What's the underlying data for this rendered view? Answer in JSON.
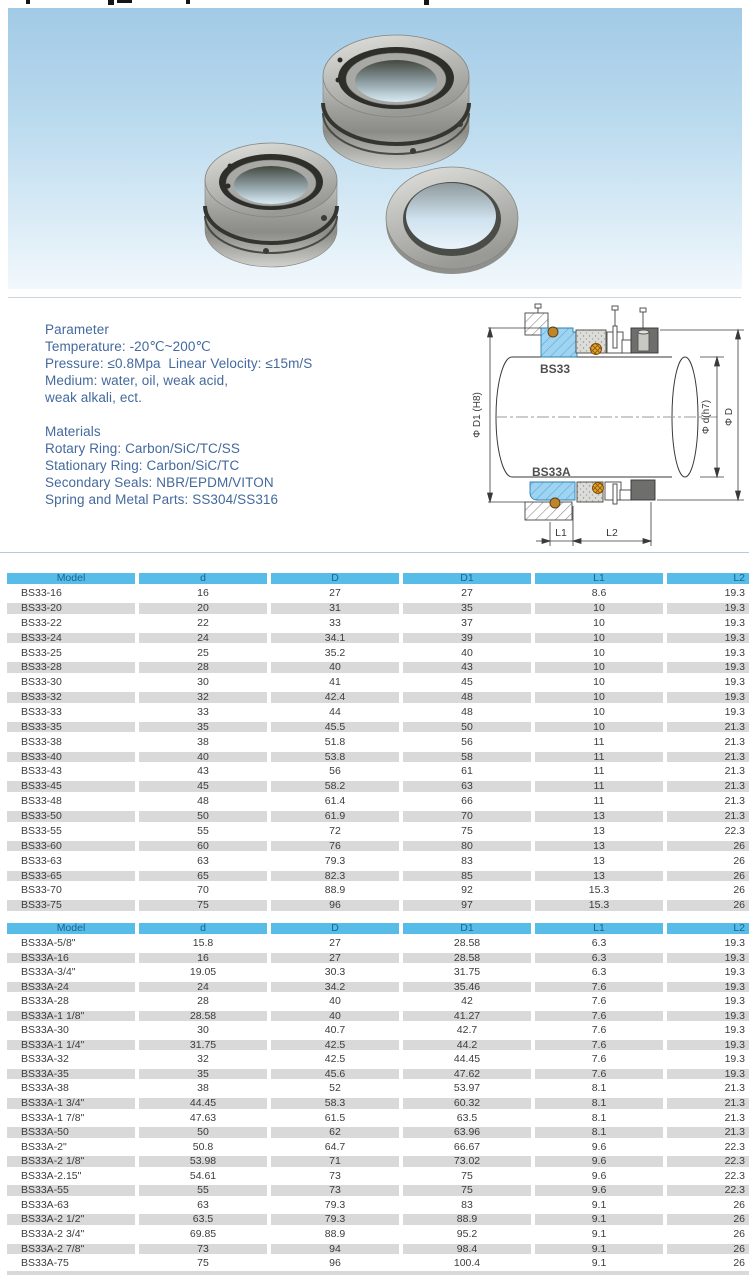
{
  "colors": {
    "table_header_bg": "#57bce8",
    "table_header_text": "#1a648f",
    "row_stripe": "#d9d9d9",
    "body_text": "#3c3c3c",
    "spec_text": "#44699d",
    "photo_bg_top": "#a2cae6",
    "diagram_blue": "#9ed4f2",
    "diagram_orange": "#e8a224"
  },
  "parameter_section": {
    "title": "Parameter",
    "lines": [
      "Temperature: -20℃~200℃",
      "Pressure: ≤0.8Mpa  Linear Velocity: ≤15m/S",
      "Medium: water, oil, weak acid,",
      "weak alkali, ect."
    ]
  },
  "materials_section": {
    "title": "Materials",
    "lines": [
      "Rotary Ring: Carbon/SiC/TC/SS",
      "Stationary Ring: Carbon/SiC/TC",
      "Secondary Seals: NBR/EPDM/VITON",
      "Spring and Metal Parts: SS304/SS316"
    ]
  },
  "diagram": {
    "top_model": "BS33",
    "bottom_model": "BS33A",
    "dim_bore": "Φ D1 (H8)",
    "dim_shaft": "Φ d(h7)",
    "dim_outer": "Φ D",
    "dim_l1": "L1",
    "dim_l2": "L2"
  },
  "tables": [
    {
      "columns": [
        "Model",
        "d",
        "D",
        "D1",
        "L1",
        "L2"
      ],
      "rows": [
        [
          "BS33-16",
          "16",
          "27",
          "27",
          "8.6",
          "19.3"
        ],
        [
          "BS33-20",
          "20",
          "31",
          "35",
          "10",
          "19.3"
        ],
        [
          "BS33-22",
          "22",
          "33",
          "37",
          "10",
          "19.3"
        ],
        [
          "BS33-24",
          "24",
          "34.1",
          "39",
          "10",
          "19.3"
        ],
        [
          "BS33-25",
          "25",
          "35.2",
          "40",
          "10",
          "19.3"
        ],
        [
          "BS33-28",
          "28",
          "40",
          "43",
          "10",
          "19.3"
        ],
        [
          "BS33-30",
          "30",
          "41",
          "45",
          "10",
          "19.3"
        ],
        [
          "BS33-32",
          "32",
          "42.4",
          "48",
          "10",
          "19.3"
        ],
        [
          "BS33-33",
          "33",
          "44",
          "48",
          "10",
          "19.3"
        ],
        [
          "BS33-35",
          "35",
          "45.5",
          "50",
          "10",
          "21.3"
        ],
        [
          "BS33-38",
          "38",
          "51.8",
          "56",
          "11",
          "21.3"
        ],
        [
          "BS33-40",
          "40",
          "53.8",
          "58",
          "11",
          "21.3"
        ],
        [
          "BS33-43",
          "43",
          "56",
          "61",
          "11",
          "21.3"
        ],
        [
          "BS33-45",
          "45",
          "58.2",
          "63",
          "11",
          "21.3"
        ],
        [
          "BS33-48",
          "48",
          "61.4",
          "66",
          "11",
          "21.3"
        ],
        [
          "BS33-50",
          "50",
          "61.9",
          "70",
          "13",
          "21.3"
        ],
        [
          "BS33-55",
          "55",
          "72",
          "75",
          "13",
          "22.3"
        ],
        [
          "BS33-60",
          "60",
          "76",
          "80",
          "13",
          "26"
        ],
        [
          "BS33-63",
          "63",
          "79.3",
          "83",
          "13",
          "26"
        ],
        [
          "BS33-65",
          "65",
          "82.3",
          "85",
          "13",
          "26"
        ],
        [
          "BS33-70",
          "70",
          "88.9",
          "92",
          "15.3",
          "26"
        ],
        [
          "BS33-75",
          "75",
          "96",
          "97",
          "15.3",
          "26"
        ]
      ]
    },
    {
      "columns": [
        "Model",
        "d",
        "D",
        "D1",
        "L1",
        "L2"
      ],
      "rows": [
        [
          "BS33A-5/8\"",
          "15.8",
          "27",
          "28.58",
          "6.3",
          "19.3"
        ],
        [
          "BS33A-16",
          "16",
          "27",
          "28.58",
          "6.3",
          "19.3"
        ],
        [
          "BS33A-3/4\"",
          "19.05",
          "30.3",
          "31.75",
          "6.3",
          "19.3"
        ],
        [
          "BS33A-24",
          "24",
          "34.2",
          "35.46",
          "7.6",
          "19.3"
        ],
        [
          "BS33A-28",
          "28",
          "40",
          "42",
          "7.6",
          "19.3"
        ],
        [
          "BS33A-1 1/8\"",
          "28.58",
          "40",
          "41.27",
          "7.6",
          "19.3"
        ],
        [
          "BS33A-30",
          "30",
          "40.7",
          "42.7",
          "7.6",
          "19.3"
        ],
        [
          "BS33A-1 1/4\"",
          "31.75",
          "42.5",
          "44.2",
          "7.6",
          "19.3"
        ],
        [
          "BS33A-32",
          "32",
          "42.5",
          "44.45",
          "7.6",
          "19.3"
        ],
        [
          "BS33A-35",
          "35",
          "45.6",
          "47.62",
          "7.6",
          "19.3"
        ],
        [
          "BS33A-38",
          "38",
          "52",
          "53.97",
          "8.1",
          "21.3"
        ],
        [
          "BS33A-1 3/4\"",
          "44.45",
          "58.3",
          "60.32",
          "8.1",
          "21.3"
        ],
        [
          "BS33A-1 7/8\"",
          "47.63",
          "61.5",
          "63.5",
          "8.1",
          "21.3"
        ],
        [
          "BS33A-50",
          "50",
          "62",
          "63.96",
          "8.1",
          "21.3"
        ],
        [
          "BS33A-2\"",
          "50.8",
          "64.7",
          "66.67",
          "9.6",
          "22.3"
        ],
        [
          "BS33A-2 1/8\"",
          "53.98",
          "71",
          "73.02",
          "9.6",
          "22.3"
        ],
        [
          "BS33A-2.15\"",
          "54.61",
          "73",
          "75",
          "9.6",
          "22.3"
        ],
        [
          "BS33A-55",
          "55",
          "73",
          "75",
          "9.6",
          "22.3"
        ],
        [
          "BS33A-63",
          "63",
          "79.3",
          "83",
          "9.1",
          "26"
        ],
        [
          "BS33A-2 1/2\"",
          "63.5",
          "79.3",
          "88.9",
          "9.1",
          "26"
        ],
        [
          "BS33A-2 3/4\"",
          "69.85",
          "88.9",
          "95.2",
          "9.1",
          "26"
        ],
        [
          "BS33A-2 7/8\"",
          "73",
          "94",
          "98.4",
          "9.1",
          "26"
        ],
        [
          "BS33A-75",
          "75",
          "96",
          "100.4",
          "9.1",
          "26"
        ]
      ]
    }
  ]
}
